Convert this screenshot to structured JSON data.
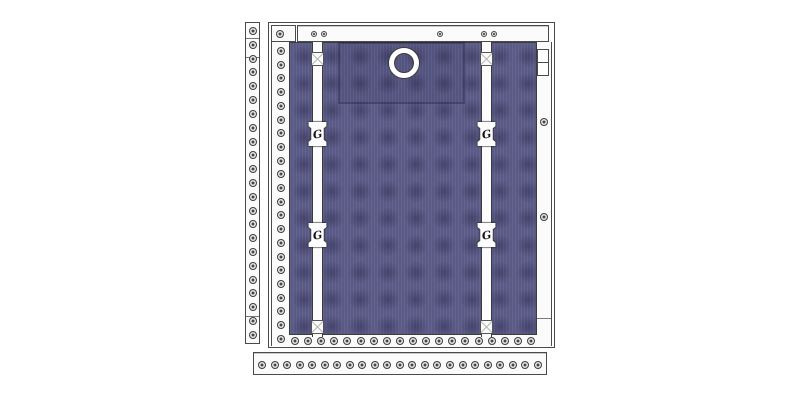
{
  "drawing": {
    "description": "Technical product drawing: quilted fabric panel in a frame with two webbing straps, buckles, a grommet ring and perforated mounting rails",
    "colors": {
      "fabric": "#5a5a87",
      "part_white": "#fbfbfb",
      "outline": "#4a4a4a",
      "background": "#ffffff"
    },
    "counts": {
      "left_rail_holes": 23,
      "frame_left_strip_holes": 22,
      "frame_bottom_strip_holes": 19,
      "frame_right_strip_holes": 2,
      "corner_box_holes": 1,
      "top_rail_screws": 5,
      "bottom_rail_holes": 23
    },
    "straps": [
      {
        "buckles": [
          "G",
          "G"
        ]
      },
      {
        "buckles": [
          "G",
          "G"
        ]
      }
    ]
  }
}
